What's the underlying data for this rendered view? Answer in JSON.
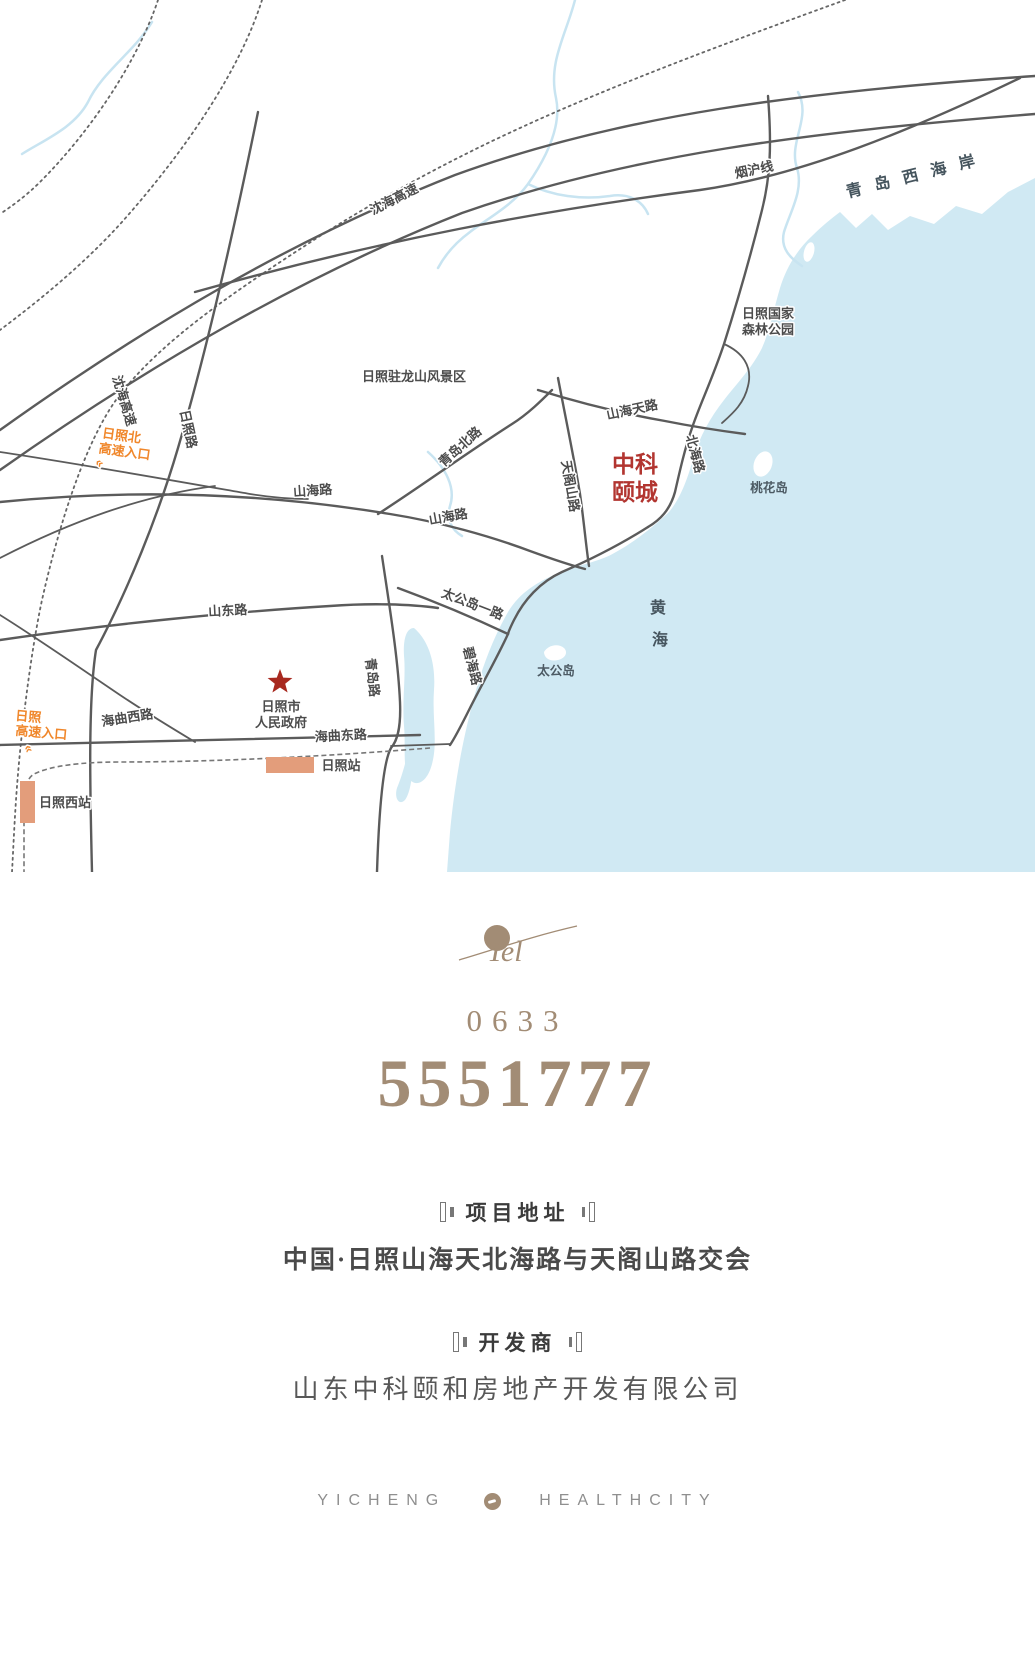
{
  "theme": {
    "sea": "#d0e9f3",
    "river": "#c8e4f1",
    "road": "#5b5b5b",
    "rail": "#777777",
    "red": "#a8291f",
    "project_red": "#b23530",
    "orange": "#f0872b",
    "station": "#e39d7b",
    "taupe": "#a28c75",
    "heading": "#3b3b3b",
    "textgray": "#4a4a4a",
    "footergray": "#8f8f8f"
  },
  "map": {
    "labels": {
      "yanhu_line": "烟沪线",
      "qingdao_west_coast": "青岛西海岸",
      "shenhai_expwy_top": "沈海高速",
      "shenhai_expwy_left": "沈海高速",
      "rizhao_road": "日照路",
      "rizhao_north_entrance_l1": "日照北",
      "rizhao_north_entrance_l2": "高速入口",
      "north_entrance_arrows": "«",
      "zhulongshan_scenic": "日照驻龙山风景区",
      "forest_park_l1": "日照国家",
      "forest_park_l2": "森林公园",
      "shanhaitian_road": "山海天路",
      "beihai_road": "北海路",
      "tiangeshan_road": "天阁山路",
      "project_l1": "中科",
      "project_l2": "颐城",
      "taohua_island": "桃花岛",
      "qingdao_north_road": "青岛北路",
      "shanhai_road_1": "山海路",
      "shanhai_road_2": "山海路",
      "shandong_road": "山东路",
      "taigongdao_first_road": "太公岛一路",
      "bihai_road": "碧海路",
      "taigong_island": "太公岛",
      "yellow_sea_l1": "黄",
      "yellow_sea_l2": "海",
      "gov_l1": "日照市",
      "gov_l2": "人民政府",
      "qingdao_road": "青岛路",
      "haiqu_west_road": "海曲西路",
      "haiqu_east_road": "海曲东路",
      "rizhao_station": "日照站",
      "rizhao_west_station": "日照西站",
      "rizhao_entrance_l1": "日照",
      "rizhao_entrance_l2": "高速入口",
      "entrance_arrows": "«"
    }
  },
  "contact": {
    "tel_label": "Tel",
    "area_code": "0633",
    "phone": "5551777"
  },
  "address_section": {
    "heading": "项目地址",
    "value": "中国·日照山海天北海路与天阁山路交会"
  },
  "developer_section": {
    "heading": "开发商",
    "value": "山东中科颐和房地产开发有限公司"
  },
  "footer": {
    "left": "YICHENG",
    "right": "HEALTHCITY"
  }
}
